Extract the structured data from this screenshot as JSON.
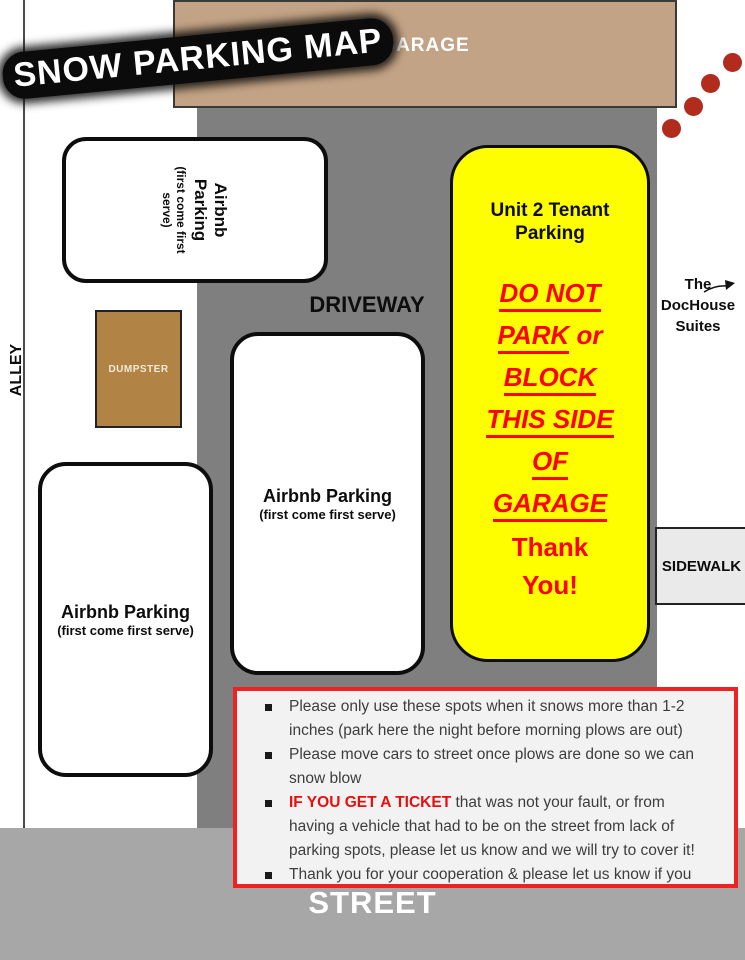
{
  "title": "SNOW PARKING MAP",
  "map": {
    "garage": {
      "label": "GARAGE"
    },
    "driveway": {
      "label": "DRIVEWAY"
    },
    "alley": {
      "label": "ALLEY"
    },
    "street": {
      "label": "STREET"
    },
    "sidewalk": {
      "label": "SIDEWALK"
    },
    "dumpster": {
      "label": "DUMPSTER"
    },
    "airbnb_top": {
      "line1": "Airbnb",
      "line2": "Parking",
      "note": "(first come first serve)"
    },
    "airbnb_middle": {
      "label": "Airbnb Parking",
      "note": "(first come first serve)"
    },
    "airbnb_bottom": {
      "label": "Airbnb Parking",
      "note": "(first come first serve)"
    },
    "unit2": {
      "header_line1": "Unit 2 Tenant",
      "header_line2": "Parking",
      "warning_lines": [
        {
          "underlined": "DO NOT",
          "rest": ""
        },
        {
          "underlined": "PARK",
          "rest": " or"
        },
        {
          "underlined": "BLOCK",
          "rest": ""
        },
        {
          "underlined": "THIS SIDE",
          "rest": ""
        },
        {
          "underlined": "OF",
          "rest": ""
        },
        {
          "underlined": "GARAGE",
          "rest": ""
        }
      ],
      "thanks_line1": "Thank",
      "thanks_line2": "You!"
    },
    "dochouse": {
      "line1": "The",
      "line2": "DocHouse",
      "line3": "Suites"
    }
  },
  "notes": {
    "bullets": [
      {
        "bold_red": "",
        "lines": [
          "Please only use these spots when it snows more than 1-2",
          "inches (park here the night before morning plows are out)"
        ]
      },
      {
        "bold_red": "",
        "lines": [
          "Please move cars to street once plows are done so we can",
          "snow blow"
        ]
      },
      {
        "bold_red": "IF YOU GET A TICKET",
        "lines": [
          " that was not your fault, or from",
          "having a vehicle that had to be on the street from lack of",
          "parking spots, please let us know and we will try to cover it!"
        ]
      },
      {
        "bold_red": "",
        "lines": [
          "Thank you for your cooperation & please let us know if you",
          "have any questions or need anything else at all!"
        ]
      }
    ]
  },
  "colors": {
    "garage_tan": "#c3a385",
    "dumpster_brown": "#b18345",
    "driveway_gray": "#7f7f7f",
    "street_gray": "#a7a7a7",
    "sidewalk_gray": "#eaeaea",
    "parking_yellow": "#fffe00",
    "warning_red": "#fe0101",
    "notes_border_red": "#ed2224",
    "dot_red": "#b22c1e"
  }
}
